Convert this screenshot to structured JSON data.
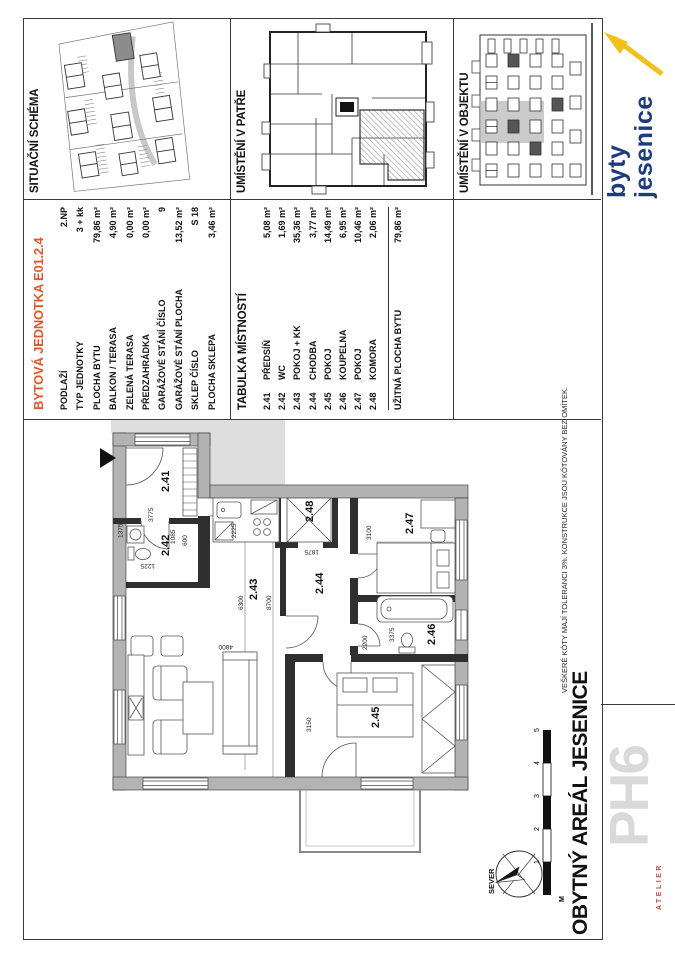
{
  "colors": {
    "accent_orange": "#e2562b",
    "wall_gray": "#b3b3b3",
    "highlight_gray": "#8c8c8c",
    "brand_navy": "#1d3b7e",
    "brand_yellow": "#f2c01d"
  },
  "sections": {
    "situ_title": "SITUAČNÍ SCHÉMA",
    "patre_title": "UMÍSTĚNÍ V PATŘE",
    "objekt_title": "UMÍSTĚNÍ V OBJEKTU"
  },
  "unit_table": {
    "title": "BYTOVÁ JEDNOTKA E01.2.4",
    "rows": [
      {
        "label": "PODLAŽÍ",
        "value": "2.NP"
      },
      {
        "label": "TYP JEDNOTKY",
        "value": "3 + kk"
      },
      {
        "label": "PLOCHA BYTU",
        "value": "79,86 m²"
      },
      {
        "label": "BALKON / TERASA",
        "value": "4,90 m²"
      },
      {
        "label": "ZELENÁ TERASA",
        "value": "0,00 m²"
      },
      {
        "label": "PŘEDZAHRÁDKA",
        "value": "0,00 m²"
      },
      {
        "label": "GARÁŽOVÉ STÁNÍ ČÍSLO",
        "value": "9"
      },
      {
        "label": "GARÁŽOVÉ STÁNÍ PLOCHA",
        "value": "13,52 m²"
      },
      {
        "label": "SKLEP ČÍSLO",
        "value": "S 18"
      },
      {
        "label": "PLOCHA SKLEPA",
        "value": "3,46 m²"
      }
    ]
  },
  "rooms_table": {
    "title": "TABULKA MÍSTNOSTÍ",
    "rows": [
      {
        "num": "2.41",
        "name": "PŘEDSÍŇ",
        "area": "5,08 m²"
      },
      {
        "num": "2.42",
        "name": "WC",
        "area": "1,69 m²"
      },
      {
        "num": "2.43",
        "name": "POKOJ + KK",
        "area": "35,36 m²"
      },
      {
        "num": "2.44",
        "name": "CHODBA",
        "area": "3,77 m²"
      },
      {
        "num": "2.45",
        "name": "POKOJ",
        "area": "14,49 m²"
      },
      {
        "num": "2.46",
        "name": "KOUPELNA",
        "area": "6,95 m²"
      },
      {
        "num": "2.47",
        "name": "POKOJ",
        "area": "10,46 m²"
      },
      {
        "num": "2.48",
        "name": "KOMORA",
        "area": "2,06 m²"
      }
    ],
    "total": {
      "label": "UŽITNÁ PLOCHA BYTU",
      "value": "79,86 m²"
    }
  },
  "plan": {
    "rooms": [
      "2.41",
      "2.42",
      "2.43",
      "2.44",
      "2.45",
      "2.46",
      "2.47",
      "2.48"
    ],
    "dims": [
      "3775",
      "1375",
      "2225",
      "1085",
      "600",
      "1875",
      "3100",
      "6300",
      "8700",
      "4800",
      "3150",
      "2200",
      "3375",
      "1225"
    ],
    "north_label": "SEVER",
    "scale": [
      "M",
      "1",
      "2",
      "3",
      "4",
      "5"
    ],
    "project_title": "OBYTNÝ AREÁL JESENICE",
    "disclaimer": "VEŠKERÉ KÓTY MAJÍ TOLERANCI 3%. KONSTRUKCE JSOU KÓTOVÁNY BEZ OMÍTEK."
  },
  "logos": {
    "brand_line1": "byty",
    "brand_line2": "jesenice",
    "ph6": "PH6",
    "ph6_sub": "ATELIER"
  }
}
